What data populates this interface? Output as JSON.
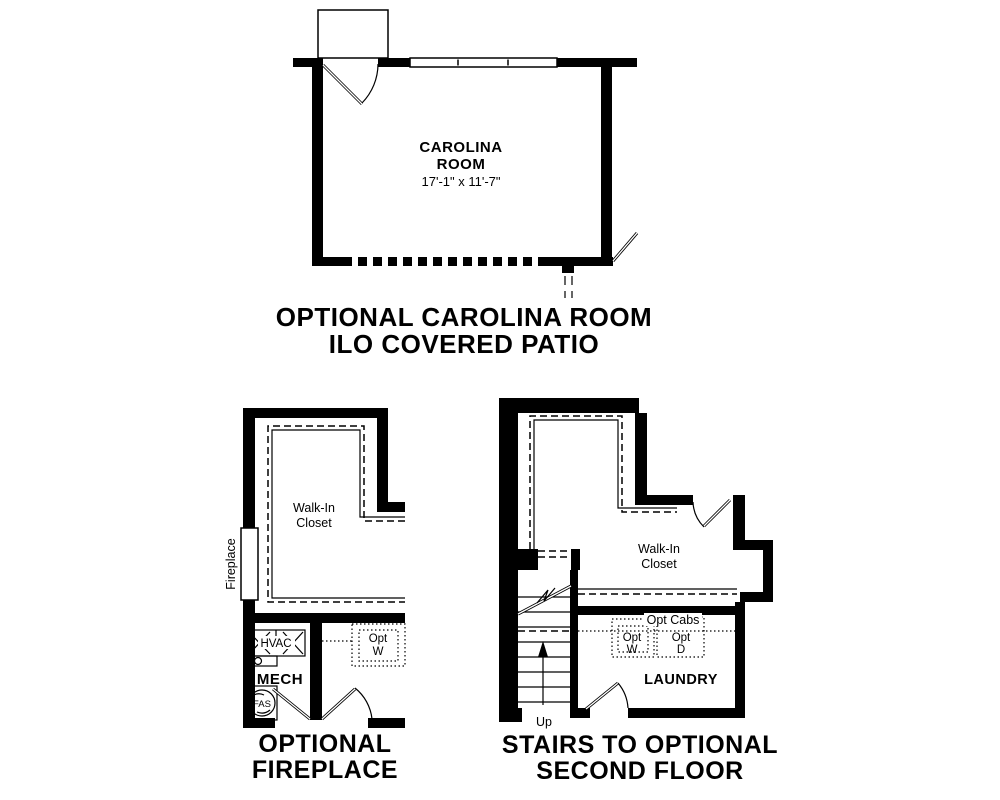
{
  "page": {
    "background": "#ffffff",
    "line_color": "#000000"
  },
  "plans": {
    "carolina_room": {
      "room_name_line1": "CAROLINA",
      "room_name_line2": "ROOM",
      "dimensions": "17'-1\" x 11'-7\"",
      "caption_line1": "OPTIONAL CAROLINA ROOM",
      "caption_line2": "ILO COVERED PATIO"
    },
    "fireplace": {
      "closet_label_line1": "Walk-In",
      "closet_label_line2": "Closet",
      "fireplace_label": "Fireplace",
      "hvac_label": "HVAC",
      "mech_label": "MECH",
      "fas_label": "FAS",
      "opt_washer_line1": "Opt",
      "opt_washer_line2": "W",
      "caption_line1": "OPTIONAL",
      "caption_line2": "FIREPLACE"
    },
    "stairs": {
      "closet_label_line1": "Walk-In",
      "closet_label_line2": "Closet",
      "opt_cabs_label": "Opt Cabs",
      "opt_washer_line1": "Opt",
      "opt_washer_line2": "W",
      "opt_dryer_line1": "Opt",
      "opt_dryer_line2": "D",
      "laundry_label": "LAUNDRY",
      "up_label": "Up",
      "caption_line1": "STAIRS TO OPTIONAL",
      "caption_line2": "SECOND FLOOR"
    }
  }
}
